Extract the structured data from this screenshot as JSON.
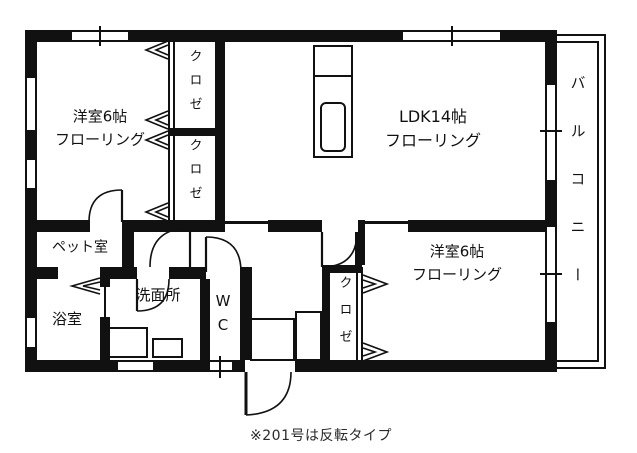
{
  "plan": {
    "rooms": {
      "bedroom1": {
        "line1": "洋室6帖",
        "line2": "フローリング"
      },
      "ldk": {
        "line1": "LDK14帖",
        "line2": "フローリング"
      },
      "bedroom2": {
        "line1": "洋室6帖",
        "line2": "フローリング"
      },
      "closet1a": {
        "label": "クロゼ"
      },
      "closet1b": {
        "label": "クロゼ"
      },
      "closet2": {
        "label": "クロゼ"
      },
      "pet_room": {
        "label": "ペット室"
      },
      "bath": {
        "label": "浴室"
      },
      "washroom": {
        "label": "洗面所"
      },
      "wc": {
        "label": "WC"
      },
      "balcony": {
        "label": "バルコニー"
      }
    },
    "caption": "※201号は反転タイプ",
    "colors": {
      "line": "#111111",
      "background": "#ffffff"
    }
  }
}
